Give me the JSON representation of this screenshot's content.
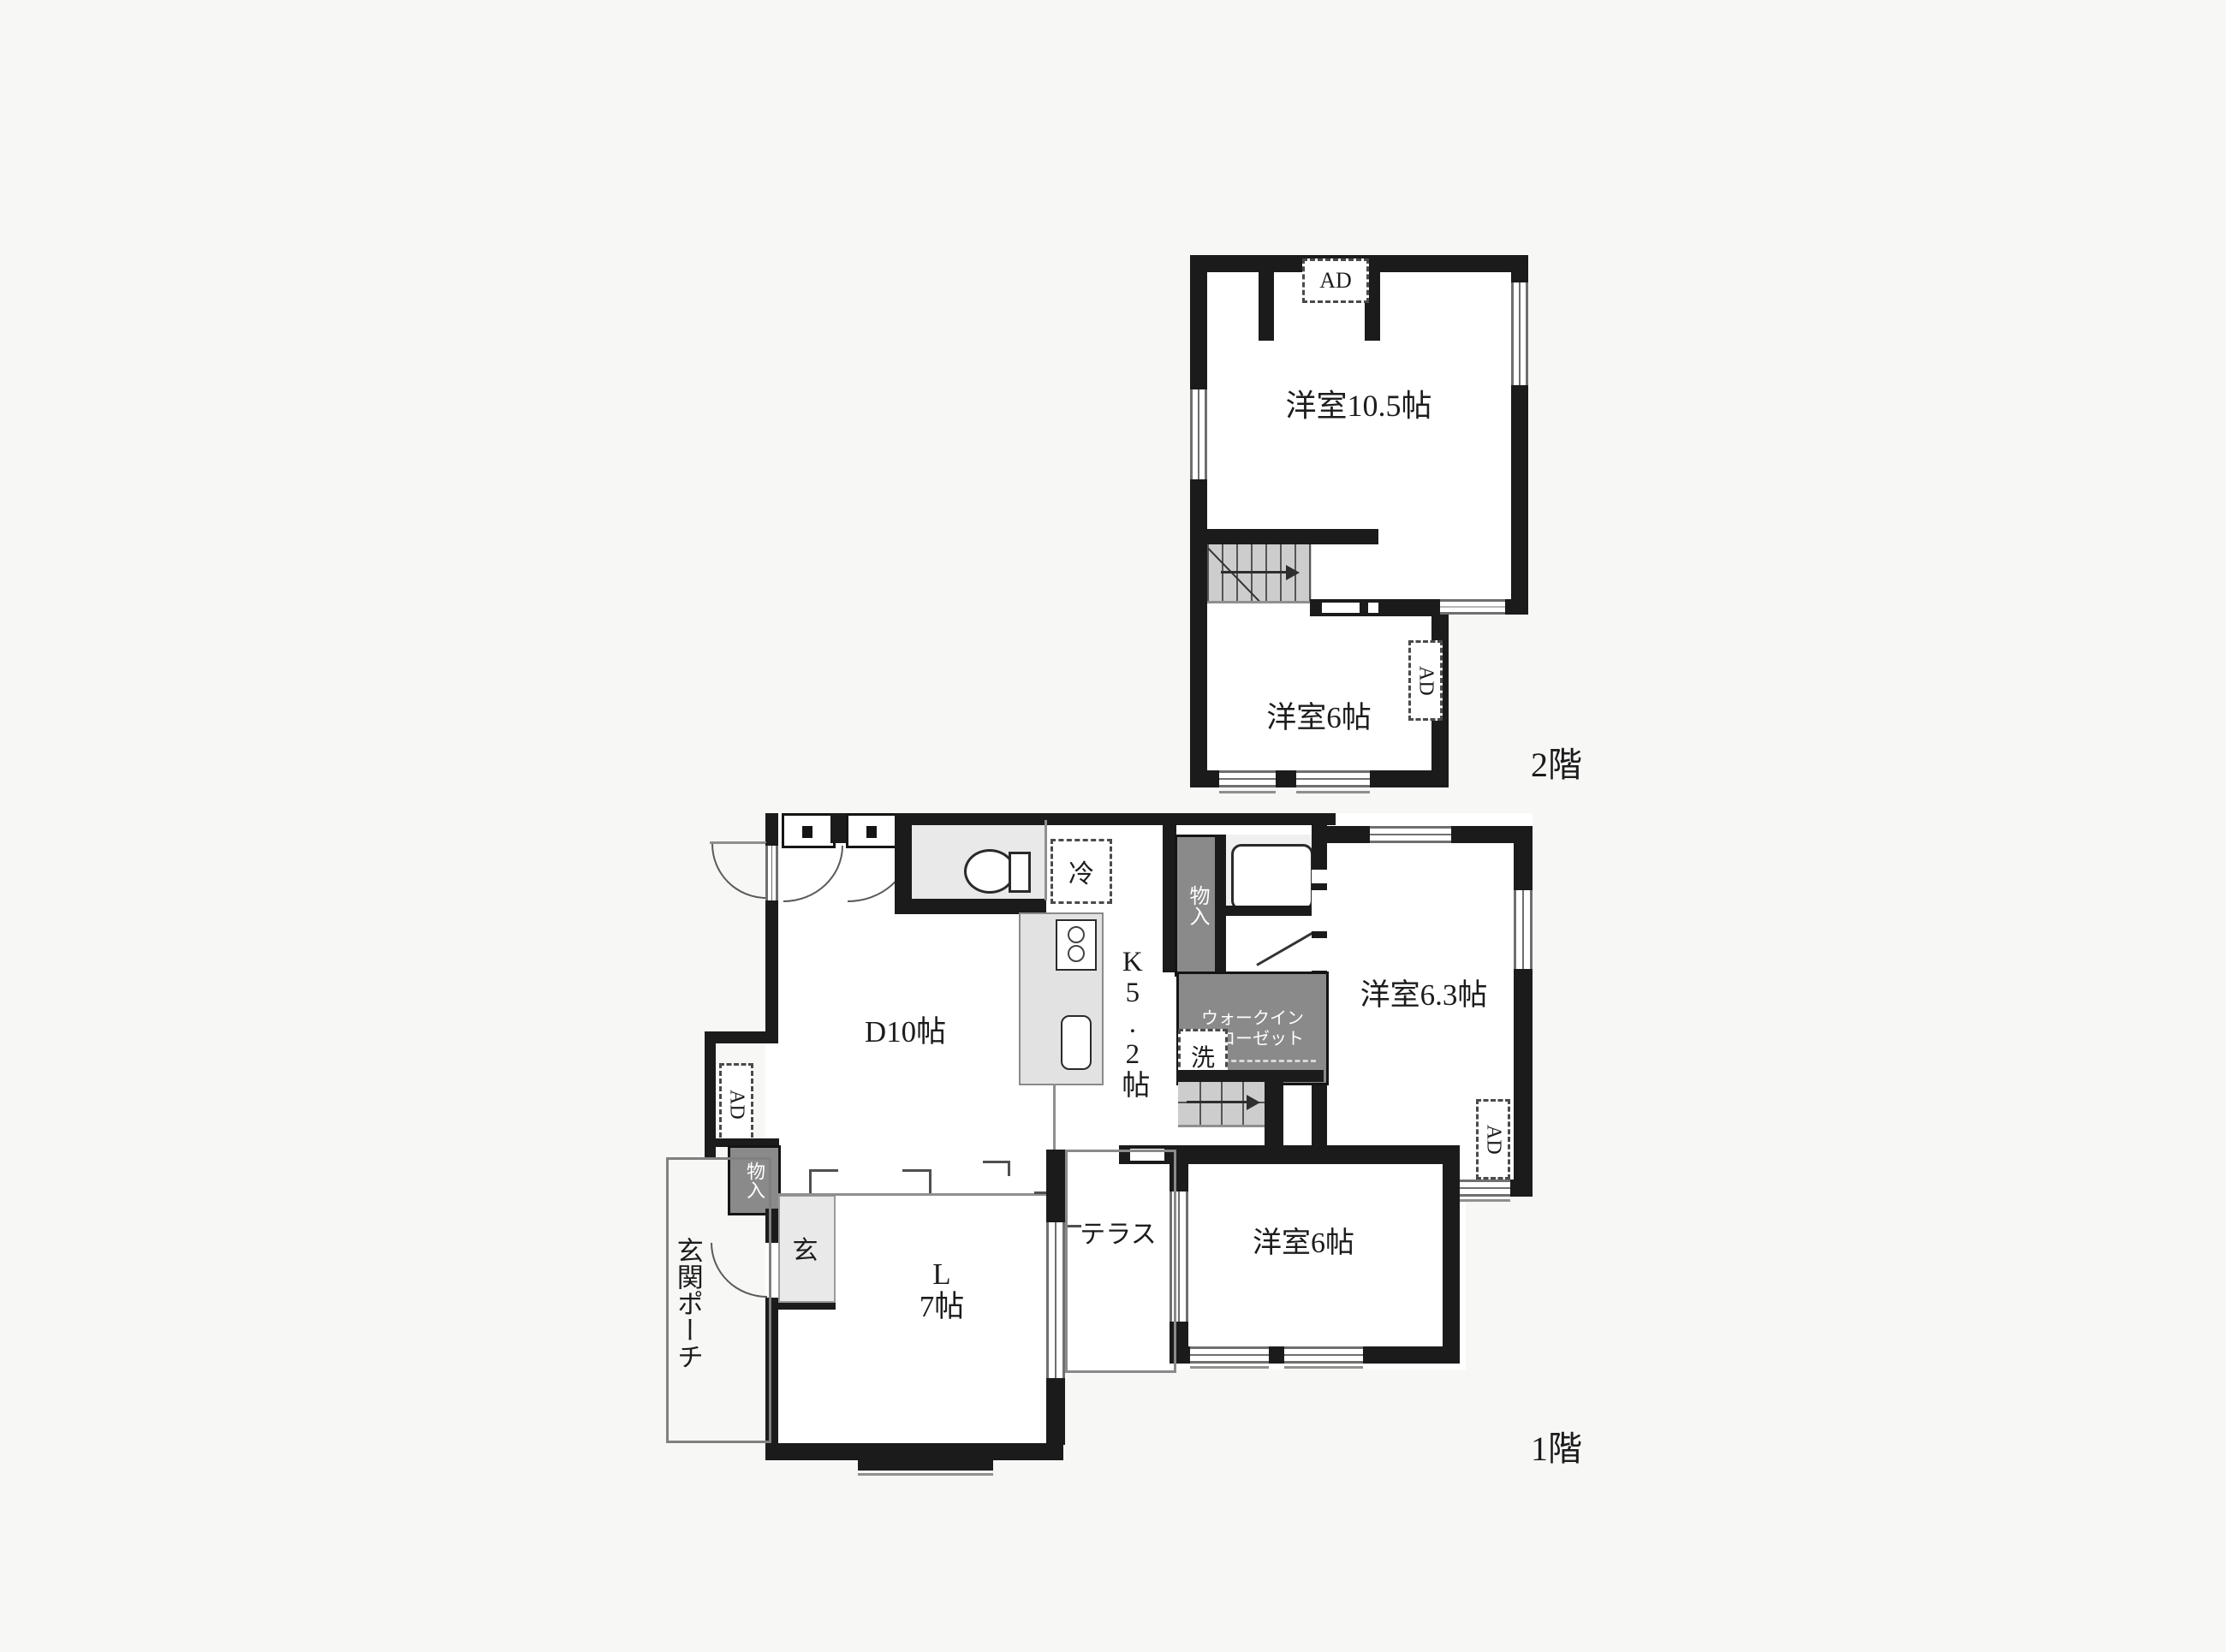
{
  "plan": {
    "floor2": {
      "name": "2階",
      "rooms": {
        "western_room_105": "洋室10.5帖",
        "western_room_6": "洋室6帖"
      }
    },
    "floor1": {
      "name": "1階",
      "rooms": {
        "dining": "D10帖",
        "kitchen": "K5.2帖",
        "living_l1": "L",
        "living_l2": "7帖",
        "western_room_63": "洋室6.3帖",
        "western_room_6": "洋室6帖",
        "terrace": "テラス",
        "entrance": "玄",
        "entrance_porch": "玄関ポーチ",
        "wic_l1": "ウォークイン",
        "wic_l2": "クローゼット"
      }
    },
    "annotations": {
      "ad": "AD",
      "closet": "物入",
      "refrigerator": "冷",
      "washer": "洗"
    },
    "colors": {
      "wall": "#1b1b1b",
      "closet_fill": "#8a8a8a",
      "stair_fill": "#cdcdcd",
      "floor_fill": "#ffffff",
      "background": "#f7f7f6"
    }
  }
}
